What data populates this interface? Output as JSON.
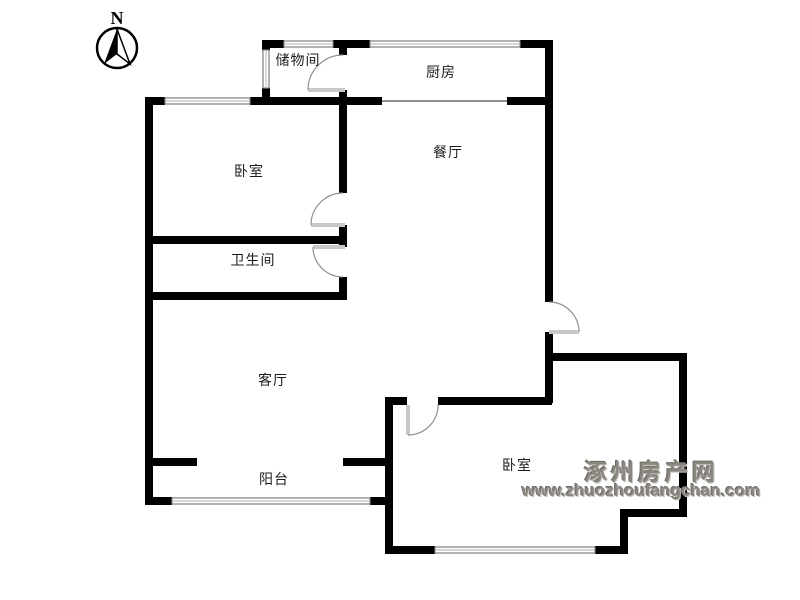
{
  "compass": {
    "label": "N"
  },
  "rooms": [
    {
      "id": "storage",
      "label": "储物间"
    },
    {
      "id": "kitchen",
      "label": "厨房"
    },
    {
      "id": "bedroom-top",
      "label": "卧室"
    },
    {
      "id": "dining",
      "label": "餐厅"
    },
    {
      "id": "bathroom",
      "label": "卫生间"
    },
    {
      "id": "living",
      "label": "客厅"
    },
    {
      "id": "balcony",
      "label": "阳台"
    },
    {
      "id": "bedroom-right",
      "label": "卧室"
    }
  ],
  "watermark": {
    "site_name": "涿州房产网",
    "site_url": "www.zhuozhoufangchan.com",
    "color": "#8a8680"
  },
  "colors": {
    "wall": "#000000",
    "window_line": "#7d7d7d",
    "window_mid": "#bdbdbd",
    "door_arc": "#8f8f8f",
    "door_leaf": "#c8c8c8",
    "background": "#ffffff",
    "label": "#1c1c1c"
  }
}
